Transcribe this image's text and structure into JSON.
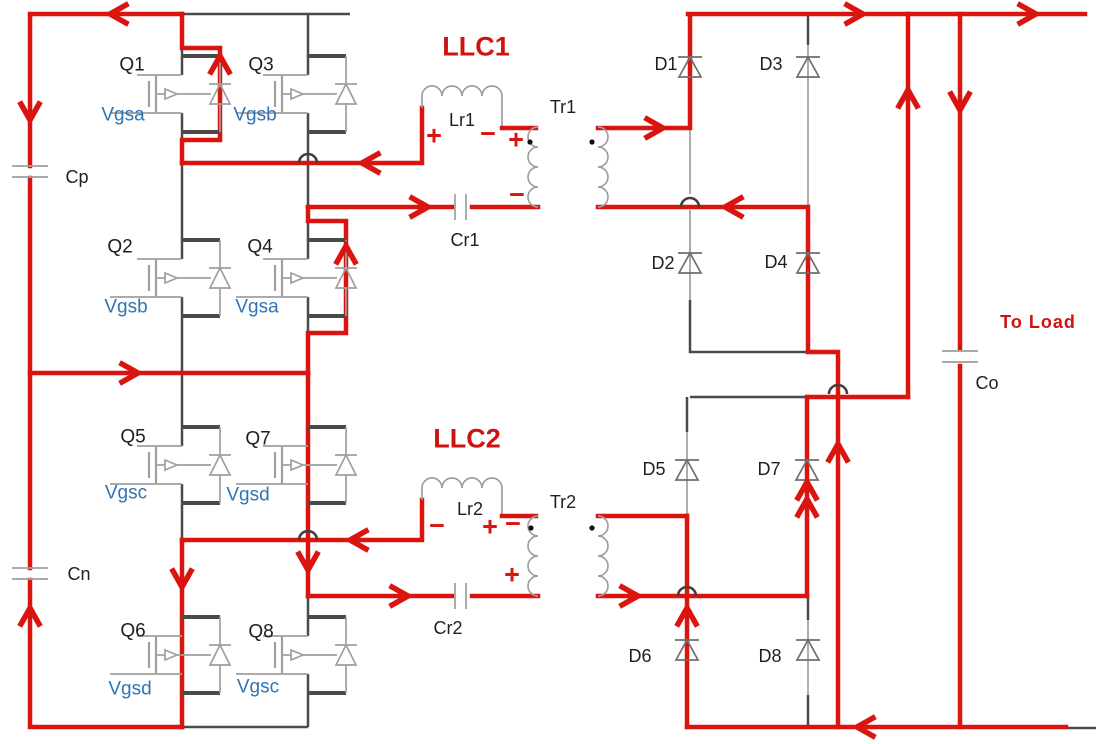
{
  "diagram": {
    "description": "Stacked dual full-bridge LLC resonant converter with highlighted current flow paths",
    "stage1_label": "LLC1",
    "stage2_label": "LLC2",
    "load_label": "To Load"
  },
  "colors": {
    "current_path": "#da1510",
    "wire": "#4a4a4a",
    "symbol": "#9f9f9f",
    "gate_signal_text": "#2e75b6",
    "component_text": "#1f1f1f"
  },
  "switches": [
    {
      "id": "Q1",
      "gate": "Vgsa"
    },
    {
      "id": "Q3",
      "gate": "Vgsb"
    },
    {
      "id": "Q2",
      "gate": "Vgsb"
    },
    {
      "id": "Q4",
      "gate": "Vgsa"
    },
    {
      "id": "Q5",
      "gate": "Vgsc"
    },
    {
      "id": "Q7",
      "gate": "Vgsd"
    },
    {
      "id": "Q6",
      "gate": "Vgsd"
    },
    {
      "id": "Q8",
      "gate": "Vgsc"
    }
  ],
  "diodes": [
    "D1",
    "D2",
    "D3",
    "D4",
    "D5",
    "D6",
    "D7",
    "D8"
  ],
  "capacitors": {
    "input_top": "Cp",
    "input_bottom": "Cn",
    "resonant1": "Cr1",
    "resonant2": "Cr2",
    "output": "Co"
  },
  "inductors": {
    "resonant1": "Lr1",
    "resonant2": "Lr2"
  },
  "transformers": {
    "t1": "Tr1",
    "t2": "Tr2"
  },
  "polarity": {
    "plus": "+",
    "minus": "−"
  }
}
